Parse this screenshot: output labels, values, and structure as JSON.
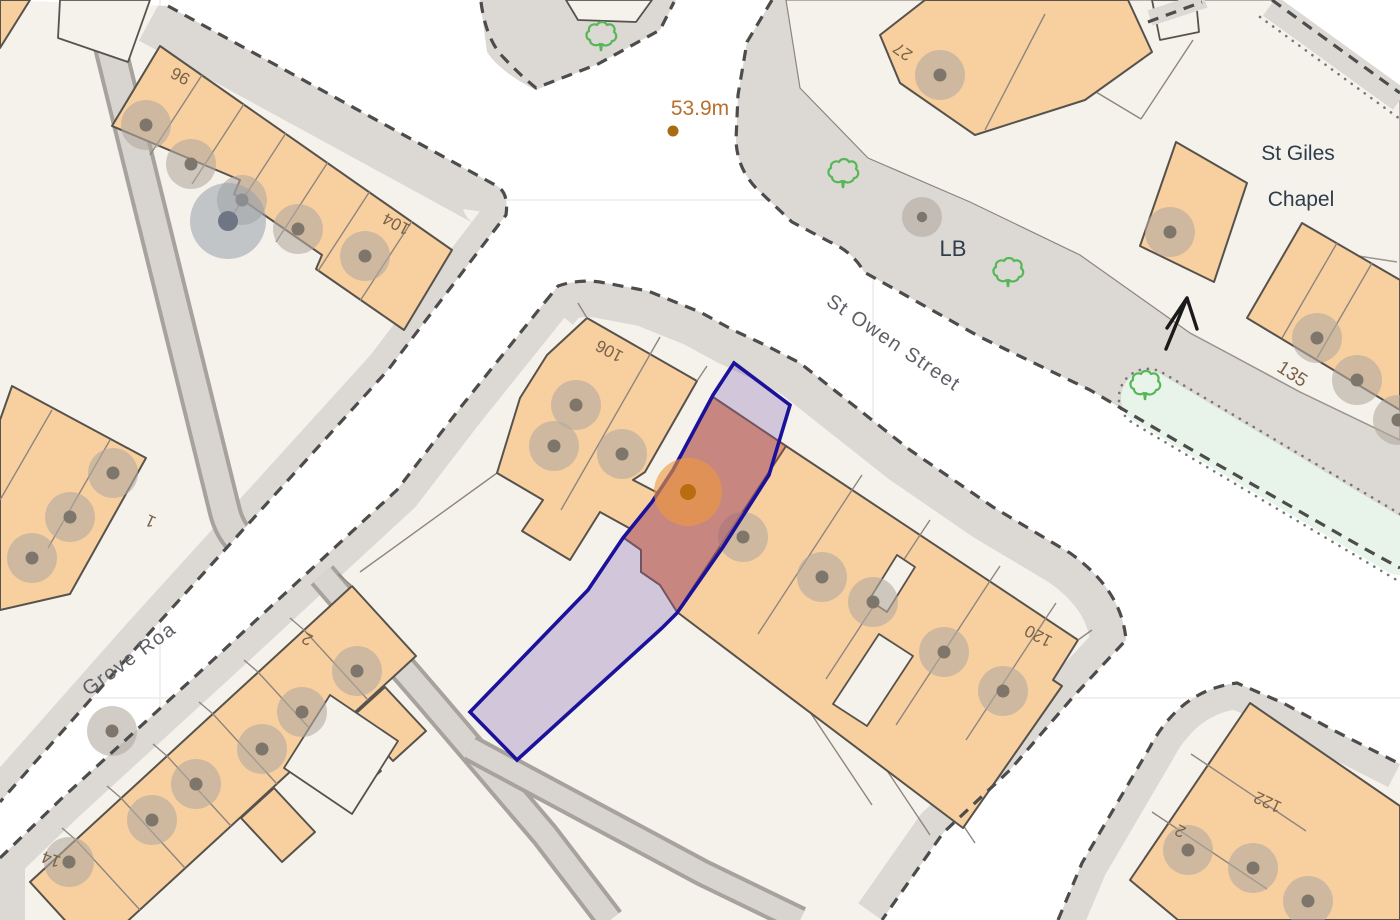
{
  "map": {
    "streets": {
      "st_owen": "St Owen Street",
      "grove": "Grove Roa"
    },
    "places": {
      "st_giles_line1": "St Giles",
      "st_giles_line2": "Chapel",
      "letter_box": "LB"
    },
    "spot_height": "53.9m",
    "house_numbers": {
      "h96": "96",
      "h104": "104",
      "h27": "27",
      "h106": "106",
      "h120": "120",
      "h135": "135",
      "h1": "1",
      "h2_grove": "2",
      "h14": "14",
      "h2_br": "2",
      "h122": "122"
    },
    "colors": {
      "building": "#f8d0a0",
      "building_outline": "#57524c",
      "plot": "#f5f2ec",
      "pavement": "#dcd8d3",
      "boundary_dash": "#4c4c4c",
      "highlight_outline": "#1b129b",
      "highlight_fill": "rgba(128,96,180,0.30)",
      "building_highlight_fill": "rgba(180,75,70,0.40)",
      "marker_orange": "#ef9a3e",
      "tree_green": "#55b757",
      "verge_green": "#e8f4e9",
      "number_text": "#7a6248",
      "street_text": "#5f5f68",
      "place_text": "#2e3c4c",
      "spot_text": "#b5712f"
    },
    "icons": {
      "tree": "tree-icon",
      "building_dot": "building-dot-icon",
      "large_building_dot": "large-building-dot-icon",
      "property_marker": "property-marker",
      "direction_arrow": "direction-arrow-icon",
      "spot_height_dot": "spot-height-dot"
    }
  }
}
